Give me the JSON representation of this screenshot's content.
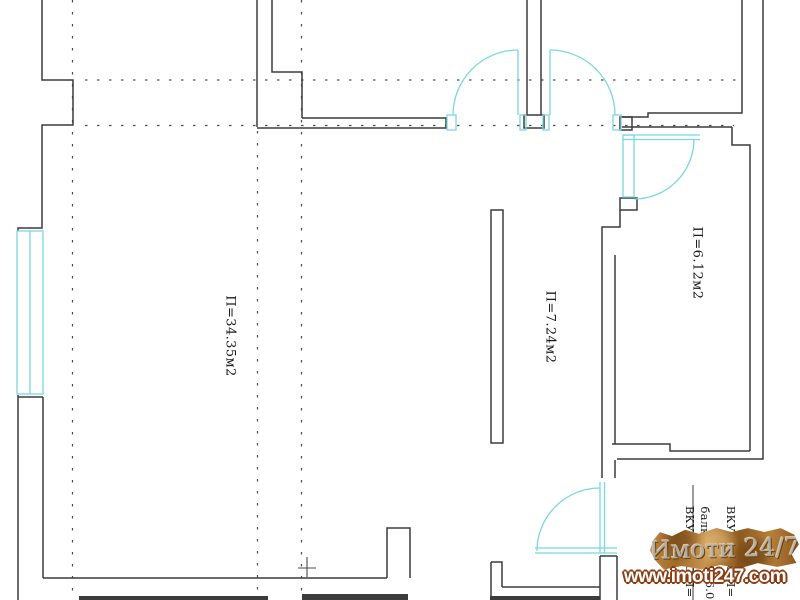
{
  "plan": {
    "room_labels": {
      "living": "П=34.35м2",
      "hall": "П=7.24м2",
      "balcony": "П=6.12м2"
    },
    "annotations": {
      "left_top": "ВКУ",
      "left_bottom": "С П=",
      "mid_top": "балк",
      "mid_bottom": "П=6.0",
      "right_top": "ВКУ",
      "right_bottom": "С П="
    },
    "colors": {
      "wall": "#3c3c3c",
      "fixture_accent": "#79d8de",
      "grid_dash": "#4a4a4a",
      "background": "#ffffff"
    }
  },
  "watermark": {
    "brand": "Имоти 24/7",
    "url": "www.imoti247.com"
  }
}
